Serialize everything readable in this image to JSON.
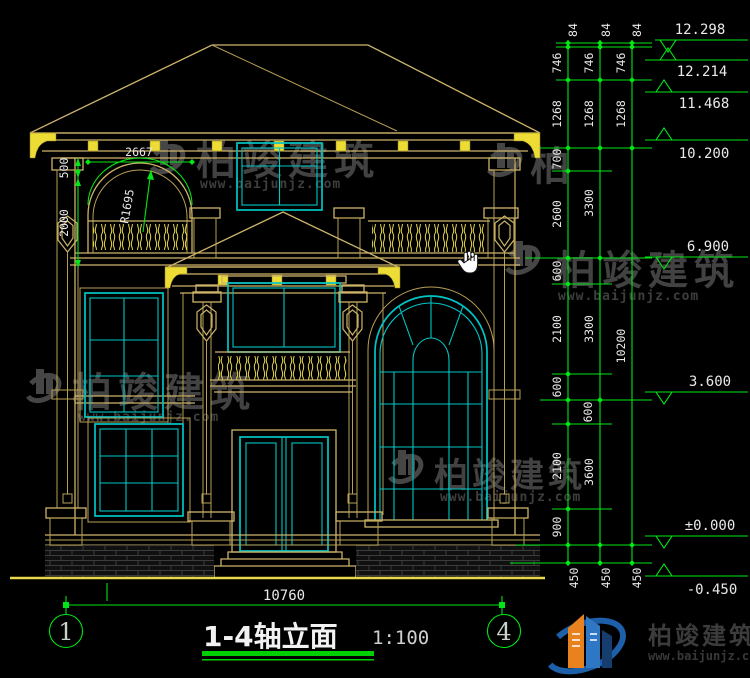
{
  "drawing": {
    "title": "1-4轴立面",
    "scale": "1:100",
    "axis_start": "1",
    "axis_end": "4",
    "bottom_dim": "10760",
    "arch_width_dim": "2667",
    "arch_radius_dim": "R1695",
    "left_dims": {
      "upper": "500",
      "lower": "2000"
    },
    "elevations": [
      "12.298",
      "12.214",
      "11.468",
      "10.200",
      "6.900",
      "3.600",
      "±0.000",
      "-0.450"
    ],
    "right_chain_inner": [
      "84",
      "746",
      "1268",
      "700",
      "2600",
      "600",
      "2100",
      "600",
      "600",
      "2100",
      "900",
      "450"
    ],
    "right_chain_mid": [
      "84",
      "746",
      "1268",
      "3300",
      "3300",
      "3600",
      "450"
    ],
    "right_chain_outer": [
      "84",
      "746",
      "1268",
      "10200",
      "450"
    ]
  },
  "watermark": {
    "brand": "柏竣建筑",
    "url": "www.baijunjz.com",
    "partial": "柏"
  },
  "logo": {
    "brand": "柏竣建筑",
    "url": "www.baijunjz.com"
  },
  "cursor": "pan-hand",
  "colors": {
    "background": "#000000",
    "line": "#cdb36a",
    "window": "#00c6c6",
    "dimension": "#00e616",
    "text": "#e9e9e9"
  }
}
